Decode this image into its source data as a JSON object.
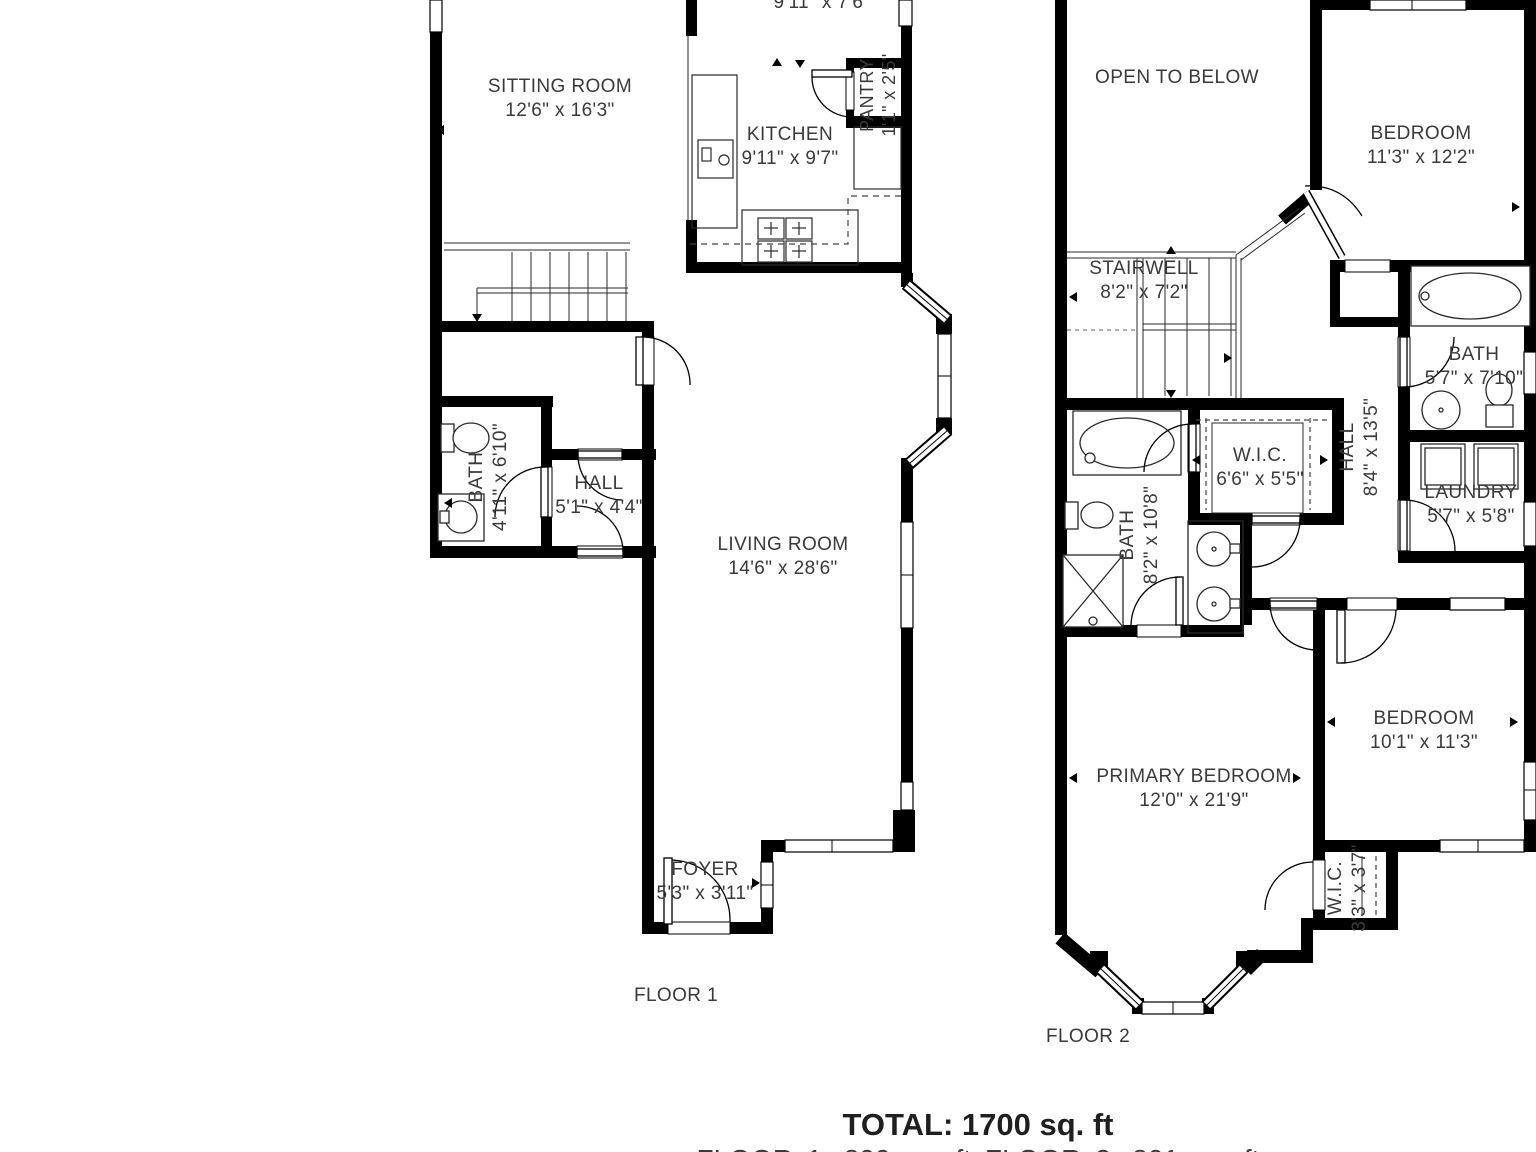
{
  "floor1": {
    "label": "FLOOR 1",
    "rooms": {
      "dining": {
        "dims": "9'11\" x 7'6\""
      },
      "sitting": {
        "name": "SITTING ROOM",
        "dims": "12'6\" x 16'3\""
      },
      "kitchen": {
        "name": "KITCHEN",
        "dims": "9'11\" x 9'7\""
      },
      "pantry": {
        "name": "PANTRY",
        "dims": "1'1\" x 2'5\""
      },
      "bath": {
        "name": "BATH",
        "dims": "4'11\" x 6'10\""
      },
      "hall": {
        "name": "HALL",
        "dims": "5'1\" x 4'4\""
      },
      "living": {
        "name": "LIVING ROOM",
        "dims": "14'6\" x 28'6\""
      },
      "foyer": {
        "name": "FOYER",
        "dims": "5'3\" x 3'11\""
      }
    }
  },
  "floor2": {
    "label": "FLOOR 2",
    "rooms": {
      "open_below": {
        "name": "OPEN TO BELOW"
      },
      "bedroom_top": {
        "name": "BEDROOM",
        "dims": "11'3\" x 12'2\""
      },
      "stairwell": {
        "name": "STAIRWELL",
        "dims": "8'2\" x 7'2\""
      },
      "bath_hall": {
        "name": "BATH",
        "dims": "5'7\" x 7'10\""
      },
      "hall": {
        "name": "HALL",
        "dims": "8'4\" x 13'5\""
      },
      "wic_hall": {
        "name": "W.I.C.",
        "dims": "6'6\" x 5'5\""
      },
      "bath_primary": {
        "name": "BATH",
        "dims": "8'2\" x 10'8\""
      },
      "laundry": {
        "name": "LAUNDRY",
        "dims": "5'7\" x 5'8\""
      },
      "primary_bedroom": {
        "name": "PRIMARY BEDROOM",
        "dims": "12'0\" x 21'9\""
      },
      "bedroom_bottom": {
        "name": "BEDROOM",
        "dims": "10'1\" x 11'3\""
      },
      "wic_primary": {
        "name": "W.I.C.",
        "dims": "3'3\" x 3'7\""
      }
    }
  },
  "summary": {
    "total": "TOTAL: 1700 sq. ft",
    "breakdown": "FLOOR 1: 899 sq. ft FLOOR 2: 801 sq. ft"
  },
  "colors": {
    "wall": "#000000",
    "text": "#3a3a3a",
    "background": "#ffffff"
  }
}
